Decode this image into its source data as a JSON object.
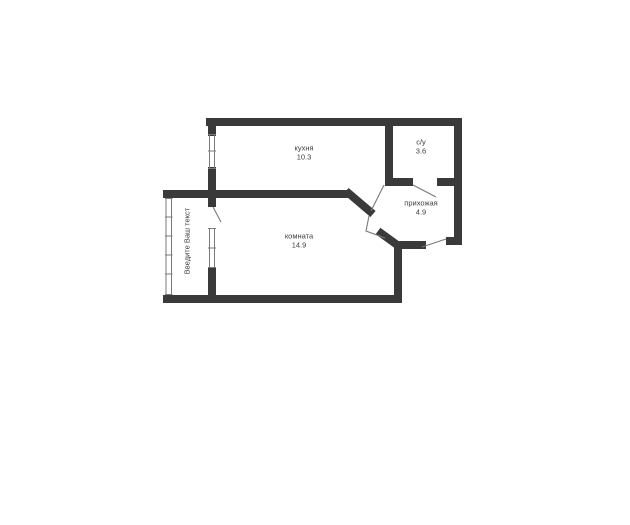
{
  "floorplan": {
    "type": "apartment-floor-plan",
    "colors": {
      "wall": "#3a3a3a",
      "line": "#7a7a7a",
      "text": "#3d3d3d",
      "bg": "#ffffff"
    },
    "rooms": [
      {
        "id": "kitchen",
        "label": "кухня",
        "area": "10.3"
      },
      {
        "id": "bathroom",
        "label": "с/у",
        "area": "3.6"
      },
      {
        "id": "hallway",
        "label": "прихожая",
        "area": "4.9"
      },
      {
        "id": "living-room",
        "label": "комната",
        "area": "14.9"
      }
    ],
    "watermark": "Введите Ваш текст"
  }
}
